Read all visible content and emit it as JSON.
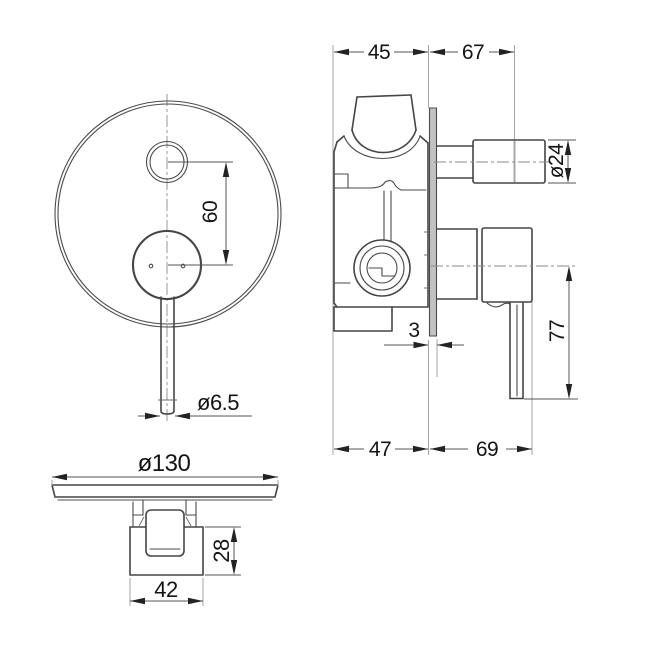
{
  "drawing": {
    "title": "concealed shower mixer dimension drawing",
    "colors": {
      "background": "#ffffff",
      "object_line": "#454545",
      "dimension_line": "#555555",
      "extension_line": "#9a9a9a",
      "text": "#141414",
      "plate_fill": "#c2c2c2"
    },
    "dims": {
      "front_button_to_handle": "60",
      "front_lever_diameter": "ø6.5",
      "side_body_depth_top": "45",
      "side_projection_top": "67",
      "side_button_diameter": "ø24",
      "side_plate_thickness": "3",
      "side_lever_length": "77",
      "side_body_depth_bottom": "47",
      "side_projection_bottom": "69",
      "bottom_plate_diameter": "ø130",
      "bottom_body_height": "28",
      "bottom_body_width": "42"
    }
  }
}
